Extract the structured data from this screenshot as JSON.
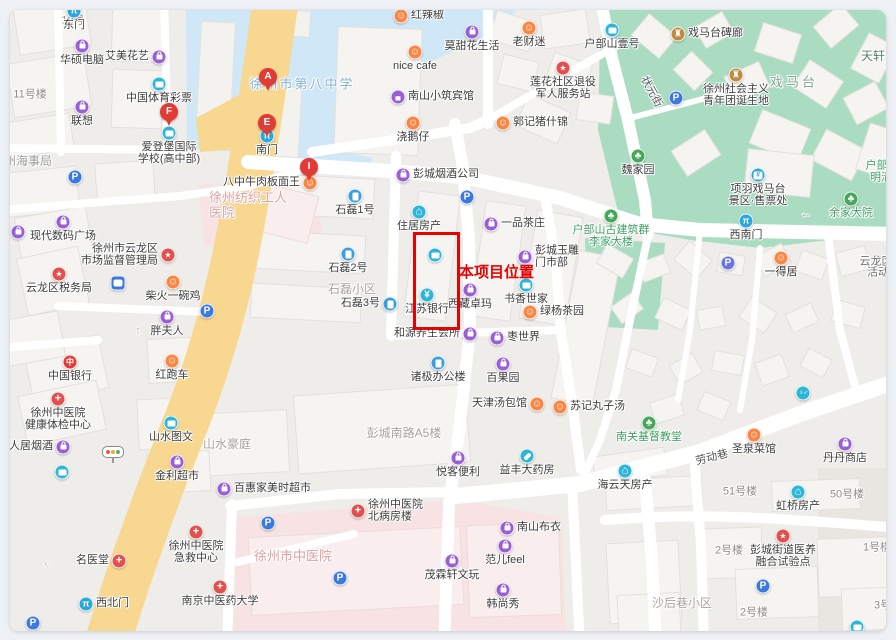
{
  "annotation": {
    "label": "本项目位置",
    "color": "#e60202",
    "box": {
      "x": 413,
      "y": 232,
      "w": 41,
      "h": 92
    },
    "label_pos": {
      "x": 459,
      "y": 261
    }
  },
  "pins": [
    {
      "letter": "A",
      "x": 268,
      "y": 77
    },
    {
      "letter": "F",
      "x": 169,
      "y": 112
    },
    {
      "letter": "E",
      "x": 267,
      "y": 123
    },
    {
      "letter": "I",
      "x": 309,
      "y": 167
    }
  ],
  "pois": [
    {
      "n": "gate-east",
      "t": "gate",
      "x": 74,
      "y": 11,
      "l": "东门",
      "lp": "b"
    },
    {
      "n": "huashuo-computer",
      "t": "bag",
      "x": 82,
      "y": 46,
      "l": "华硕电脑",
      "lp": "b"
    },
    {
      "n": "lenovo",
      "t": "bag",
      "x": 82,
      "y": 107,
      "l": "联想",
      "lp": "b"
    },
    {
      "n": "aimei-flower",
      "t": "bag",
      "x": 159,
      "y": 57,
      "l": "艾美花艺",
      "lp": "l"
    },
    {
      "n": "sports-lottery",
      "t": "card",
      "x": 159,
      "y": 84,
      "l": "中国体育彩票",
      "lp": "b"
    },
    {
      "n": "aidengbao-school",
      "t": "card",
      "x": 169,
      "y": 133,
      "l": [
        "爱登堡国际",
        "学校(高中部)"
      ],
      "lp": "b"
    },
    {
      "n": "gate-south",
      "t": "gate",
      "x": 267,
      "y": 136,
      "l": "南门",
      "lp": "b"
    },
    {
      "n": "honglajiao",
      "t": "food",
      "x": 401,
      "y": 16,
      "l": "红辣椒",
      "lp": "r"
    },
    {
      "n": "nice-cafe",
      "t": "food",
      "x": 415,
      "y": 52,
      "l": "nice cafe",
      "lp": "b"
    },
    {
      "n": "motianhua-life",
      "t": "bag",
      "x": 472,
      "y": 32,
      "l": "莫甜花生活",
      "lp": "b"
    },
    {
      "n": "laocaimi",
      "t": "food",
      "x": 529,
      "y": 28,
      "l": "老财迷",
      "lp": "b"
    },
    {
      "n": "hubushan-yihao",
      "t": "card",
      "x": 612,
      "y": 30,
      "l": "户部山壹号",
      "lp": "b"
    },
    {
      "n": "lianhua-veteran-station",
      "t": "star",
      "x": 563,
      "y": 68,
      "l": [
        "莲花社区退役",
        "军人服务站"
      ],
      "lp": "b"
    },
    {
      "n": "nanshan-hotel",
      "t": "hotel",
      "x": 398,
      "y": 97,
      "l": "南山小筑宾馆",
      "lp": "r"
    },
    {
      "n": "guoji-pig",
      "t": "food",
      "x": 503,
      "y": 123,
      "l": "郭记猪什锦",
      "lp": "r"
    },
    {
      "n": "jiaoezai",
      "t": "food",
      "x": 413,
      "y": 123,
      "l": "浇鹅仔",
      "lp": "b"
    },
    {
      "n": "ximatai-beilang",
      "t": "temple",
      "x": 678,
      "y": 34,
      "l": "戏马台碑廊",
      "lp": "r"
    },
    {
      "n": "youth-league-site",
      "t": "temple",
      "x": 736,
      "y": 75,
      "l": [
        "徐州社会主义",
        "青年团诞生地"
      ],
      "lp": "b"
    },
    {
      "n": "weijiayuan",
      "t": "tree",
      "x": 638,
      "y": 156,
      "l": "魏家园",
      "lp": "b"
    },
    {
      "n": "parking-1",
      "t": "park",
      "x": 75,
      "y": 177,
      "l": "",
      "lp": "b"
    },
    {
      "n": "bazhong-beef-noodle",
      "t": "food",
      "x": 310,
      "y": 183,
      "l": "八中牛肉板面王",
      "lp": "l"
    },
    {
      "n": "pengcheng-tobacco",
      "t": "bag",
      "x": 403,
      "y": 175,
      "l": "彭城烟酒公司",
      "lp": "r"
    },
    {
      "n": "xiandai-digital-plaza",
      "t": "bag",
      "x": 63,
      "y": 222,
      "l": "现代数码广场",
      "lp": "b"
    },
    {
      "n": "bag-partial-left",
      "t": "bag",
      "x": 18,
      "y": 232,
      "l": "",
      "lp": "b"
    },
    {
      "n": "market-regulation-bureau",
      "t": "star",
      "x": 168,
      "y": 255,
      "l": [
        "徐州市云龙区",
        "市场监督管理局"
      ],
      "lp": "l"
    },
    {
      "n": "tax-bureau",
      "t": "star",
      "x": 59,
      "y": 274,
      "l": "云龙区税务局",
      "lp": "b"
    },
    {
      "n": "bus-stop",
      "t": "bus",
      "x": 118,
      "y": 283,
      "l": "",
      "lp": "b"
    },
    {
      "n": "chaihuo-chicken",
      "t": "food",
      "x": 173,
      "y": 282,
      "l": "柴火一碗鸡",
      "lp": "b"
    },
    {
      "n": "parking-2",
      "t": "park",
      "x": 207,
      "y": 311,
      "l": "",
      "lp": "b"
    },
    {
      "n": "shilei-1",
      "t": "bld",
      "x": 355,
      "y": 196,
      "l": "石磊1号",
      "lp": "b"
    },
    {
      "n": "zhuju-realty",
      "t": "home",
      "x": 419,
      "y": 212,
      "l": "住居房产",
      "lp": "b"
    },
    {
      "n": "parking-3",
      "t": "park",
      "x": 467,
      "y": 197,
      "l": "",
      "lp": "b"
    },
    {
      "n": "yipin-teahouse",
      "t": "bag",
      "x": 491,
      "y": 224,
      "l": "一品茶庄",
      "lp": "r"
    },
    {
      "n": "shilei-2",
      "t": "bld",
      "x": 348,
      "y": 254,
      "l": "石磊2号",
      "lp": "b"
    },
    {
      "n": "shilei-3",
      "t": "bld",
      "x": 390,
      "y": 304,
      "l": "石磊3号",
      "lp": "l"
    },
    {
      "n": "jiangsu-bank",
      "t": "bank",
      "x": 427,
      "y": 295,
      "l": "江苏银行",
      "lp": "b"
    },
    {
      "n": "poi-in-box",
      "t": "card",
      "x": 435,
      "y": 255,
      "l": "",
      "lp": "b"
    },
    {
      "n": "xizang-zhuoma",
      "t": "bag",
      "x": 470,
      "y": 290,
      "l": "西藏卓玛",
      "lp": "b"
    },
    {
      "n": "shuxiang-shijia",
      "t": "card",
      "x": 526,
      "y": 285,
      "l": "书香世家",
      "lp": "b"
    },
    {
      "n": "lvyang-teahouse",
      "t": "food",
      "x": 530,
      "y": 312,
      "l": "绿杨茶园",
      "lp": "r"
    },
    {
      "n": "pengcheng-jade",
      "t": "bag",
      "x": 525,
      "y": 257,
      "l": [
        "彭城玉雕",
        "门市部"
      ],
      "lp": "r"
    },
    {
      "n": "zaoshijie",
      "t": "bag",
      "x": 497,
      "y": 338,
      "l": "枣世界",
      "lp": "r"
    },
    {
      "n": "heyuan-wellness",
      "t": "bag",
      "x": 470,
      "y": 334,
      "l": "和源养生会所",
      "lp": "l"
    },
    {
      "n": "zhuji-office",
      "t": "bld",
      "x": 438,
      "y": 363,
      "l": "诸极办公楼",
      "lp": "b"
    },
    {
      "n": "baiguoyuan",
      "t": "bag",
      "x": 503,
      "y": 364,
      "l": "百果园",
      "lp": "b"
    },
    {
      "n": "tianjin-baozi",
      "t": "food",
      "x": 537,
      "y": 404,
      "l": "天津汤包馆",
      "lp": "l"
    },
    {
      "n": "suji-meatball-soup",
      "t": "food",
      "x": 560,
      "y": 407,
      "l": "苏记丸子汤",
      "lp": "r"
    },
    {
      "n": "yueke-store",
      "t": "bag",
      "x": 458,
      "y": 458,
      "l": "悦客便利",
      "lp": "b"
    },
    {
      "n": "yifeng-pharmacy",
      "t": "pill",
      "x": 527,
      "y": 456,
      "l": "益丰大药房",
      "lp": "b"
    },
    {
      "n": "nanguan-church",
      "t": "tree",
      "x": 649,
      "y": 423,
      "l": "南关基督教堂",
      "lp": "b",
      "lc": "#3f9e63"
    },
    {
      "n": "shengquan-restaurant",
      "t": "food",
      "x": 754,
      "y": 435,
      "l": "圣泉菜馆",
      "lp": "b"
    },
    {
      "n": "dandan-store",
      "t": "bag",
      "x": 845,
      "y": 444,
      "l": "丹丹商店",
      "lp": "b"
    },
    {
      "n": "toilet",
      "t": "toilet",
      "x": 803,
      "y": 393,
      "l": "",
      "lp": "b"
    },
    {
      "n": "haiyuntian-realty",
      "t": "home",
      "x": 625,
      "y": 471,
      "l": "海云天房产",
      "lp": "b"
    },
    {
      "n": "hongqiao-realty",
      "t": "home",
      "x": 798,
      "y": 492,
      "l": "虹桥房产",
      "lp": "b"
    },
    {
      "n": "pengcheng-care-site",
      "t": "star",
      "x": 783,
      "y": 536,
      "l": [
        "彭城街道医养",
        "融合试验点"
      ],
      "lp": "b"
    },
    {
      "n": "ximatai-ticket-office",
      "t": "ticket",
      "x": 758,
      "y": 175,
      "l": [
        "项羽戏马台",
        "景区·售票处"
      ],
      "lp": "b"
    },
    {
      "n": "gate-southwest",
      "t": "gate",
      "x": 746,
      "y": 221,
      "l": "西南门",
      "lp": "b"
    },
    {
      "n": "yujia-dayuan",
      "t": "tree",
      "x": 851,
      "y": 199,
      "l": "余家大院",
      "lp": "b",
      "lc": "#3f9e63"
    },
    {
      "n": "lijia-dalou",
      "t": "tree",
      "x": 611,
      "y": 216,
      "l": [
        "户部山古建筑群",
        "李家大楼"
      ],
      "lp": "b",
      "lc": "#3f9e63"
    },
    {
      "n": "yideju",
      "t": "food",
      "x": 781,
      "y": 258,
      "l": "一得居",
      "lp": "b"
    },
    {
      "n": "pangfuren",
      "t": "bag",
      "x": 167,
      "y": 317,
      "l": "胖夫人",
      "lp": "b"
    },
    {
      "n": "hongpaoche",
      "t": "food",
      "x": 172,
      "y": 361,
      "l": "红跑车",
      "lp": "b"
    },
    {
      "n": "bank-of-china",
      "t": "bank2",
      "x": 70,
      "y": 362,
      "l": "中国银行",
      "lp": "b"
    },
    {
      "n": "tcm-checkup-center",
      "t": "med",
      "x": 58,
      "y": 399,
      "l": [
        "徐州中医院",
        "健康体检中心"
      ],
      "lp": "b"
    },
    {
      "n": "mingrenju-tobacco",
      "t": "bag",
      "x": 63,
      "y": 447,
      "l": "名人居烟酒",
      "lp": "l"
    },
    {
      "n": "shanshui-print",
      "t": "card",
      "x": 171,
      "y": 423,
      "l": "山水图文",
      "lp": "b"
    },
    {
      "n": "jinli-supermarket",
      "t": "bag",
      "x": 177,
      "y": 462,
      "l": "金利超市",
      "lp": "b"
    },
    {
      "n": "baihui-supermarket",
      "t": "bag",
      "x": 224,
      "y": 489,
      "l": "百惠家美时超市",
      "lp": "r"
    },
    {
      "n": "parking-4",
      "t": "park",
      "x": 268,
      "y": 523,
      "l": "",
      "lp": "b"
    },
    {
      "n": "mingyitang",
      "t": "med",
      "x": 119,
      "y": 561,
      "l": "名医堂",
      "lp": "l"
    },
    {
      "n": "tcm-emergency-center",
      "t": "med",
      "x": 196,
      "y": 532,
      "l": [
        "徐州中医院",
        "急救中心"
      ],
      "lp": "b"
    },
    {
      "n": "nanjing-tcm-university",
      "t": "med",
      "x": 220,
      "y": 587,
      "l": "南京中医药大学",
      "lp": "b"
    },
    {
      "n": "gate-northwest",
      "t": "gate",
      "x": 86,
      "y": 604,
      "l": "西北门",
      "lp": "r"
    },
    {
      "n": "tcm-north-ward",
      "t": "med",
      "x": 358,
      "y": 511,
      "l": [
        "徐州中医院",
        "北病房楼"
      ],
      "lp": "r"
    },
    {
      "n": "parking-5",
      "t": "park",
      "x": 340,
      "y": 578,
      "l": "",
      "lp": "b"
    },
    {
      "n": "maolinxuan-antiques",
      "t": "bag",
      "x": 452,
      "y": 561,
      "l": "茂霖轩文玩",
      "lp": "b"
    },
    {
      "n": "nanshan-buyi",
      "t": "bag",
      "x": 507,
      "y": 528,
      "l": "南山布衣",
      "lp": "r"
    },
    {
      "n": "faner-feel",
      "t": "bag",
      "x": 505,
      "y": 546,
      "l": "范儿feel",
      "lp": "b"
    },
    {
      "n": "hanshangxiu",
      "t": "bag",
      "x": 503,
      "y": 590,
      "l": "韩尚秀",
      "lp": "b"
    },
    {
      "n": "parking-6",
      "t": "parkp",
      "x": 728,
      "y": 263,
      "l": "",
      "lp": "b"
    },
    {
      "n": "parking-7",
      "t": "park",
      "x": 763,
      "y": 586,
      "l": "",
      "lp": "b"
    },
    {
      "n": "parking-8",
      "t": "park",
      "x": 676,
      "y": 98,
      "l": "",
      "lp": "b"
    },
    {
      "n": "teal-poi-1",
      "t": "card",
      "x": 62,
      "y": 472,
      "l": "",
      "lp": "b"
    },
    {
      "n": "parking-9",
      "t": "park",
      "x": 33,
      "y": 623,
      "l": "",
      "lp": "b"
    },
    {
      "n": "teal-poi-2",
      "t": "card",
      "x": 857,
      "y": 627,
      "l": "",
      "lp": "b"
    },
    {
      "n": "traffic-light",
      "t": "light",
      "x": 113,
      "y": 452,
      "l": "",
      "lp": "b"
    }
  ],
  "labels": [
    {
      "t": "10号",
      "x": 73,
      "y": 21,
      "c": "#8f8b85",
      "s": 11
    },
    {
      "t": "11号楼",
      "x": 30,
      "y": 95,
      "c": "#8f8b85",
      "s": 11
    },
    {
      "t": "晨光文具",
      "x": 207,
      "y": 1,
      "c": "#8f8b85",
      "s": 11
    },
    {
      "t": "大塘中村",
      "x": 302,
      "y": 1,
      "c": "#8f8b85",
      "s": 11
    },
    {
      "t": "徐州海事局",
      "x": 22,
      "y": 162,
      "c": "#9a9a9a",
      "s": 12
    },
    {
      "t": "徐州市第八中学",
      "x": 302,
      "y": 85,
      "c": "#84b1d8",
      "s": 13,
      "ls": 2
    },
    {
      "t": "徐州纺织工人\n医院",
      "x": 248,
      "y": 206,
      "c": "#df9f9f",
      "s": 13
    },
    {
      "t": "石磊小区",
      "x": 352,
      "y": 290,
      "c": "#a7a29b",
      "s": 12
    },
    {
      "t": "山水豪庭",
      "x": 227,
      "y": 445,
      "c": "#a7a29b",
      "s": 12
    },
    {
      "t": "彭城南路A5楼",
      "x": 404,
      "y": 434,
      "c": "#a7a29b",
      "s": 12
    },
    {
      "t": "徐州市中医院",
      "x": 293,
      "y": 557,
      "c": "#df9f9f",
      "s": 13
    },
    {
      "t": "沙后巷小区",
      "x": 682,
      "y": 604,
      "c": "#a7a29b",
      "s": 12
    },
    {
      "t": "戏马台",
      "x": 794,
      "y": 83,
      "c": "#7fa98c",
      "s": 13,
      "ls": 3
    },
    {
      "t": "状元街",
      "x": 651,
      "y": 92,
      "c": "#555555",
      "s": 11,
      "r": 62
    },
    {
      "t": "劳动巷",
      "x": 712,
      "y": 458,
      "c": "#555555",
      "s": 11,
      "r": -14
    },
    {
      "t": "51号楼",
      "x": 740,
      "y": 492,
      "c": "#8f8b85",
      "s": 11
    },
    {
      "t": "50号楼",
      "x": 847,
      "y": 495,
      "c": "#8f8b85",
      "s": 11
    },
    {
      "t": "2号楼",
      "x": 729,
      "y": 551,
      "c": "#8f8b85",
      "s": 11
    },
    {
      "t": "1号楼",
      "x": 877,
      "y": 548,
      "c": "#8f8b85",
      "s": 11
    },
    {
      "t": "2号楼",
      "x": 754,
      "y": 613,
      "c": "#8f8b85",
      "s": 11
    },
    {
      "t": "3号楼",
      "x": 888,
      "y": 606,
      "c": "#8f8b85",
      "s": 11
    },
    {
      "t": "云龙区",
      "x": 876,
      "y": 262,
      "c": "#6f6f6f",
      "s": 11
    },
    {
      "t": "活动",
      "x": 878,
      "y": 273,
      "c": "#6f6f6f",
      "s": 11
    },
    {
      "t": "天轩",
      "x": 873,
      "y": 57,
      "c": "#55826a",
      "s": 12
    },
    {
      "t": "户部山",
      "x": 882,
      "y": 166,
      "c": "#3f9e63",
      "s": 11
    },
    {
      "t": "明清",
      "x": 881,
      "y": 178,
      "c": "#3f9e63",
      "s": 11
    },
    {
      "t": "←",
      "x": 806,
      "y": 214,
      "c": "#9a9a9a",
      "s": 12
    },
    {
      "t": "↑",
      "x": 138,
      "y": 331,
      "c": "#b9b9b9",
      "s": 13
    },
    {
      "t": "↑",
      "x": 47,
      "y": 566,
      "c": "#b9b9b9",
      "s": 12,
      "r": -35
    }
  ]
}
